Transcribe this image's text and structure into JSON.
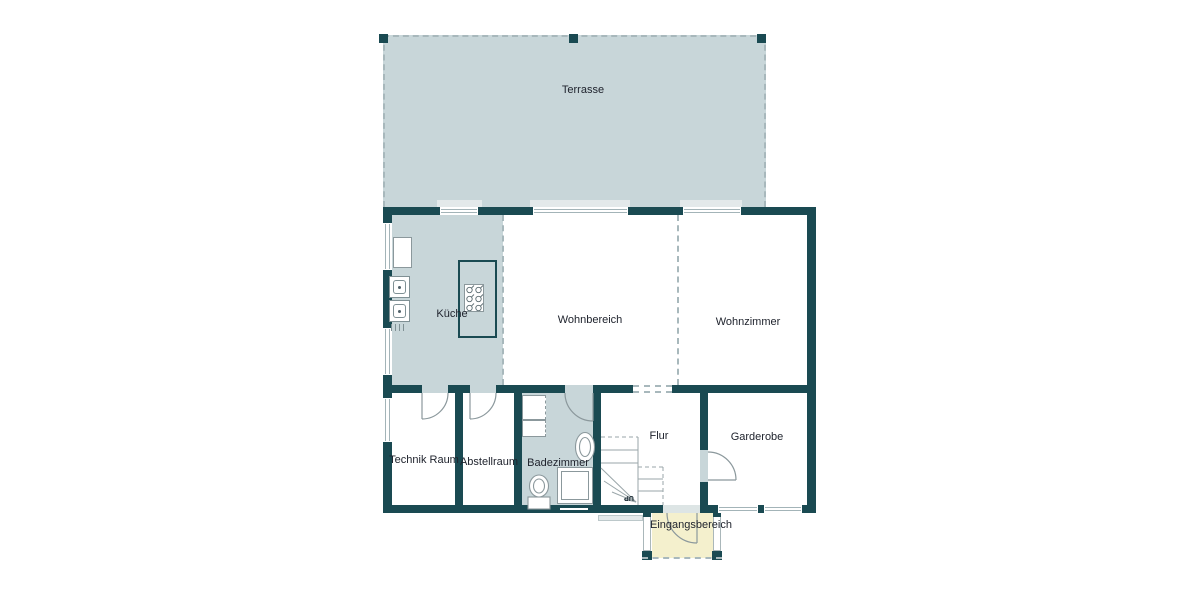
{
  "plan": {
    "type": "floor-plan",
    "language": "de",
    "rooms": [
      {
        "id": "terrasse",
        "label": "Terrasse"
      },
      {
        "id": "kueche",
        "label": "Küche"
      },
      {
        "id": "wohnbereich",
        "label": "Wohnbereich"
      },
      {
        "id": "wohnzimmer",
        "label": "Wohnzimmer"
      },
      {
        "id": "technik-raum",
        "label": "Technik Raum"
      },
      {
        "id": "abstellraum",
        "label": "Abstellraum"
      },
      {
        "id": "badezimmer",
        "label": "Badezimmer"
      },
      {
        "id": "flur",
        "label": "Flur"
      },
      {
        "id": "garderobe",
        "label": "Garderobe"
      },
      {
        "id": "eingangsbereich",
        "label": "Eingangsbereich"
      }
    ],
    "stairs": {
      "label": "UP"
    },
    "colors": {
      "wall": "#1a4a52",
      "floor_tinted": "#c8d6d9",
      "room_white": "#ffffff",
      "entry_floor": "#f4f0cd",
      "line_gray": "#8b989c",
      "text": "#20242e"
    }
  }
}
